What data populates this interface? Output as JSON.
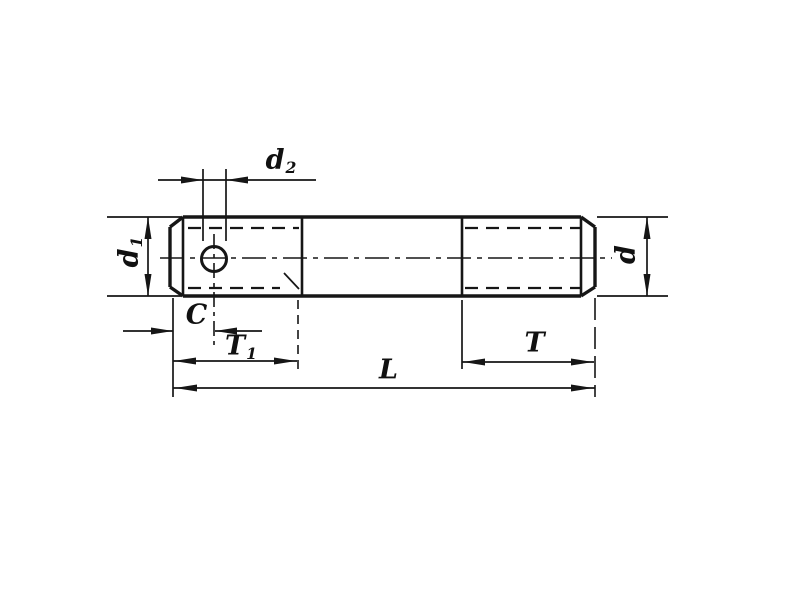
{
  "drawing": {
    "description": "Engineering dimension drawing of a double-ended threaded stud with a cross-drilled hole in the left end",
    "background_color": "#ffffff",
    "line_color": "#161616",
    "dimensions": {
      "hole_diameter": {
        "base": "d",
        "sub": "2"
      },
      "diameter_left": {
        "base": "d",
        "sub": "1"
      },
      "diameter_right": {
        "base": "d",
        "sub": ""
      },
      "hole_offset": {
        "base": "C",
        "sub": ""
      },
      "thread_length_left": {
        "base": "T",
        "sub": "1"
      },
      "thread_length_right": {
        "base": "T",
        "sub": ""
      },
      "overall_length": {
        "base": "L",
        "sub": ""
      }
    }
  }
}
